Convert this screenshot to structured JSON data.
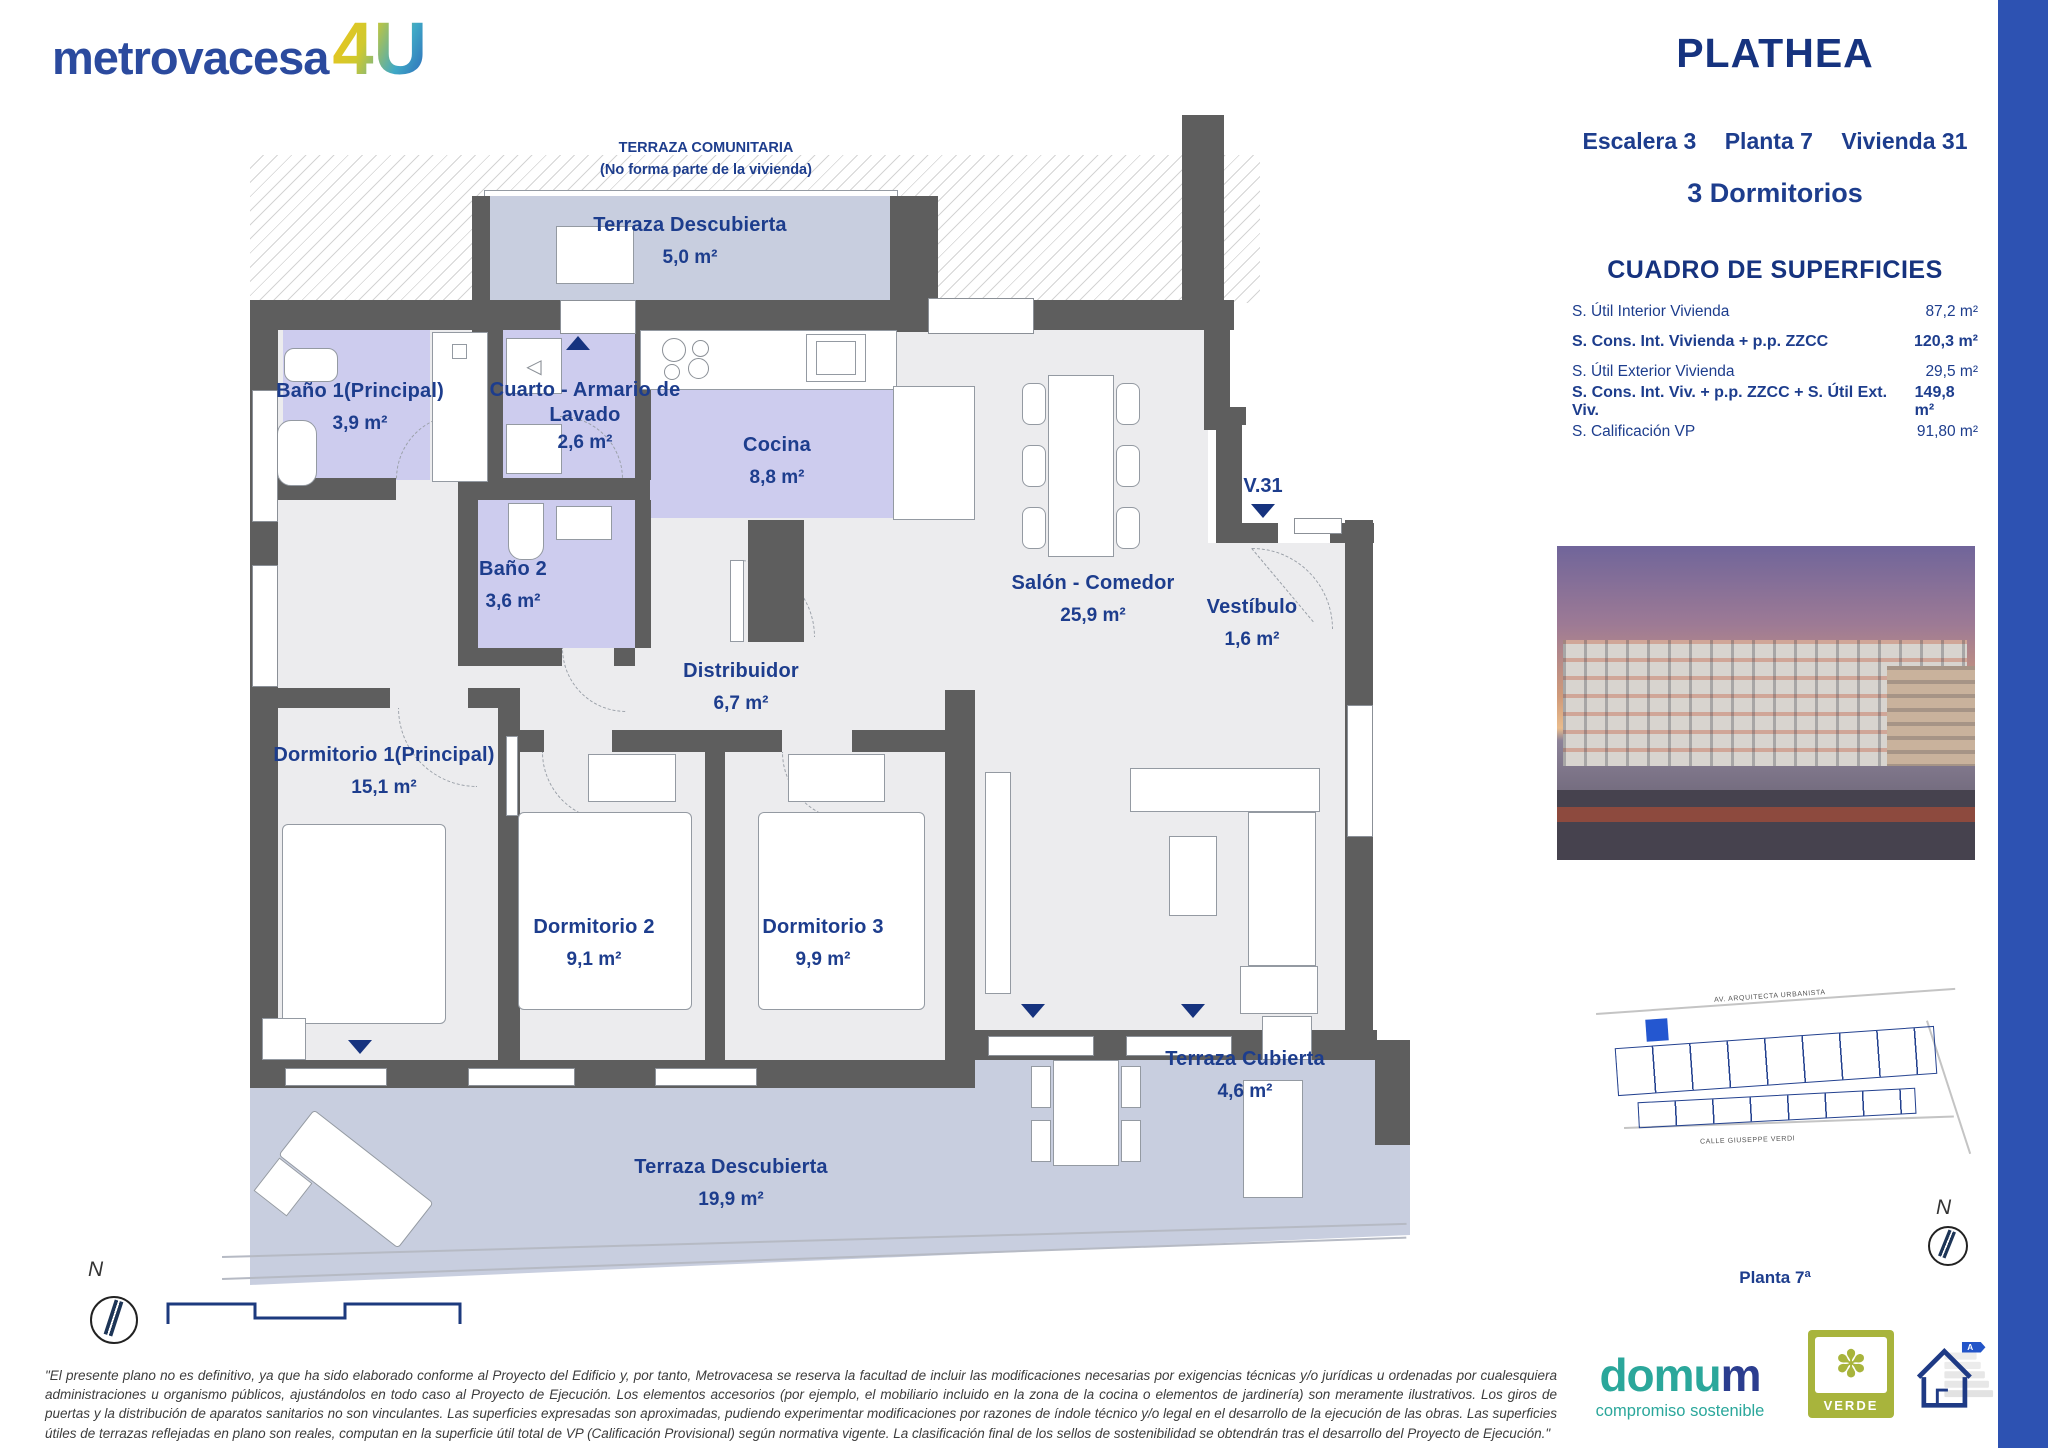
{
  "brand": {
    "name": "metrovacesa",
    "suffix": "4U"
  },
  "header": {
    "title": "PLATHEA",
    "location": [
      "Escalera 3",
      "Planta 7",
      "Vivienda 31"
    ],
    "typology": "3 Dormitorios"
  },
  "surfaces": {
    "title": "CUADRO DE SUPERFICIES",
    "rows": [
      {
        "label": "S. Útil Interior Vivienda",
        "value": "87,2 m²"
      },
      {
        "label": "S. Cons. Int. Vivienda + p.p. ZZCC",
        "value": "120,3 m²"
      },
      {
        "label": "S. Útil Exterior Vivienda",
        "value": "29,5 m²"
      },
      {
        "label": "S. Cons. Int. Viv. + p.p. ZZCC + S. Útil Ext. Viv.",
        "value": "149,8 m²"
      },
      {
        "label": "S. Calificación VP",
        "value": "91,80 m²"
      }
    ]
  },
  "plan": {
    "communal_terrace_line1": "TERRAZA COMUNITARIA",
    "communal_terrace_line2": "(No forma parte de la vivienda)",
    "entry_label": "V.31",
    "north": "N",
    "rooms": [
      {
        "name": "Terraza Descubierta",
        "area": "5,0 m²"
      },
      {
        "name": "Baño 1(Principal)",
        "area": "3,9 m²"
      },
      {
        "name": "Cuarto - Armario de Lavado",
        "area": "2,6 m²"
      },
      {
        "name": "Cocina",
        "area": "8,8 m²"
      },
      {
        "name": "Baño 2",
        "area": "3,6 m²"
      },
      {
        "name": "Distribuidor",
        "area": "6,7 m²"
      },
      {
        "name": "Salón - Comedor",
        "area": "25,9 m²"
      },
      {
        "name": "Vestíbulo",
        "area": "1,6 m²"
      },
      {
        "name": "Dormitorio 1(Principal)",
        "area": "15,1 m²"
      },
      {
        "name": "Dormitorio 2",
        "area": "9,1 m²"
      },
      {
        "name": "Dormitorio 3",
        "area": "9,9 m²"
      },
      {
        "name": "Terraza Cubierta",
        "area": "4,6 m²"
      },
      {
        "name": "Terraza Descubierta",
        "area": "19,9 m²"
      }
    ]
  },
  "site_plan": {
    "street_top": "AV. ARQUITECTA URBANISTA",
    "street_bottom": "CALLE GIUSEPPE VERDI",
    "floor_label": "Planta 7ª",
    "north": "N"
  },
  "footer": {
    "disclaimer": "\"El presente plano no es definitivo, ya que ha sido elaborado conforme al Proyecto del Edificio y, por tanto, Metrovacesa se reserva la facultad de incluir las modificaciones necesarias por exigencias técnicas y/o jurídicas u ordenadas por cualesquiera administraciones u organismo públicos, ajustándolos en todo caso al Proyecto de Ejecución. Los elementos accesorios (por ejemplo, el mobiliario incluido en la zona de la cocina o elementos de jardinería) son meramente ilustrativos. Los giros de puertas y la distribución de aparatos sanitarios no son vinculantes. Las superficies expresadas son aproximadas, pudiendo experimentar modificaciones por razones de índole técnico y/o legal en el desarrollo de la ejecución de las obras. Las superficies útiles de terrazas reflejadas en plano son reales, computan en la superficie útil total de VP (Calificación Provisional) según normativa vigente. La clasificación final de los sellos de sostenibilidad se obtendrán tras el desarrollo del Proyecto de Ejecución.\"",
    "domum_prefix": "domu",
    "domum_suffix": "m",
    "domum_tagline": "compromiso sostenible",
    "verde": "VERDE",
    "verde_icon": "✽",
    "energy_rating": "A"
  },
  "colors": {
    "navy_text": "#1d3d8d",
    "title_navy": "#16337f",
    "wet_room_fill": "#cdccee",
    "terrace_fill": "#c8cedf",
    "wall_gray": "#5e5e5e",
    "accent_bar_blue": "#2d52b2",
    "domum_teal": "#2ba79b",
    "verde_olive": "#a8b43c"
  }
}
